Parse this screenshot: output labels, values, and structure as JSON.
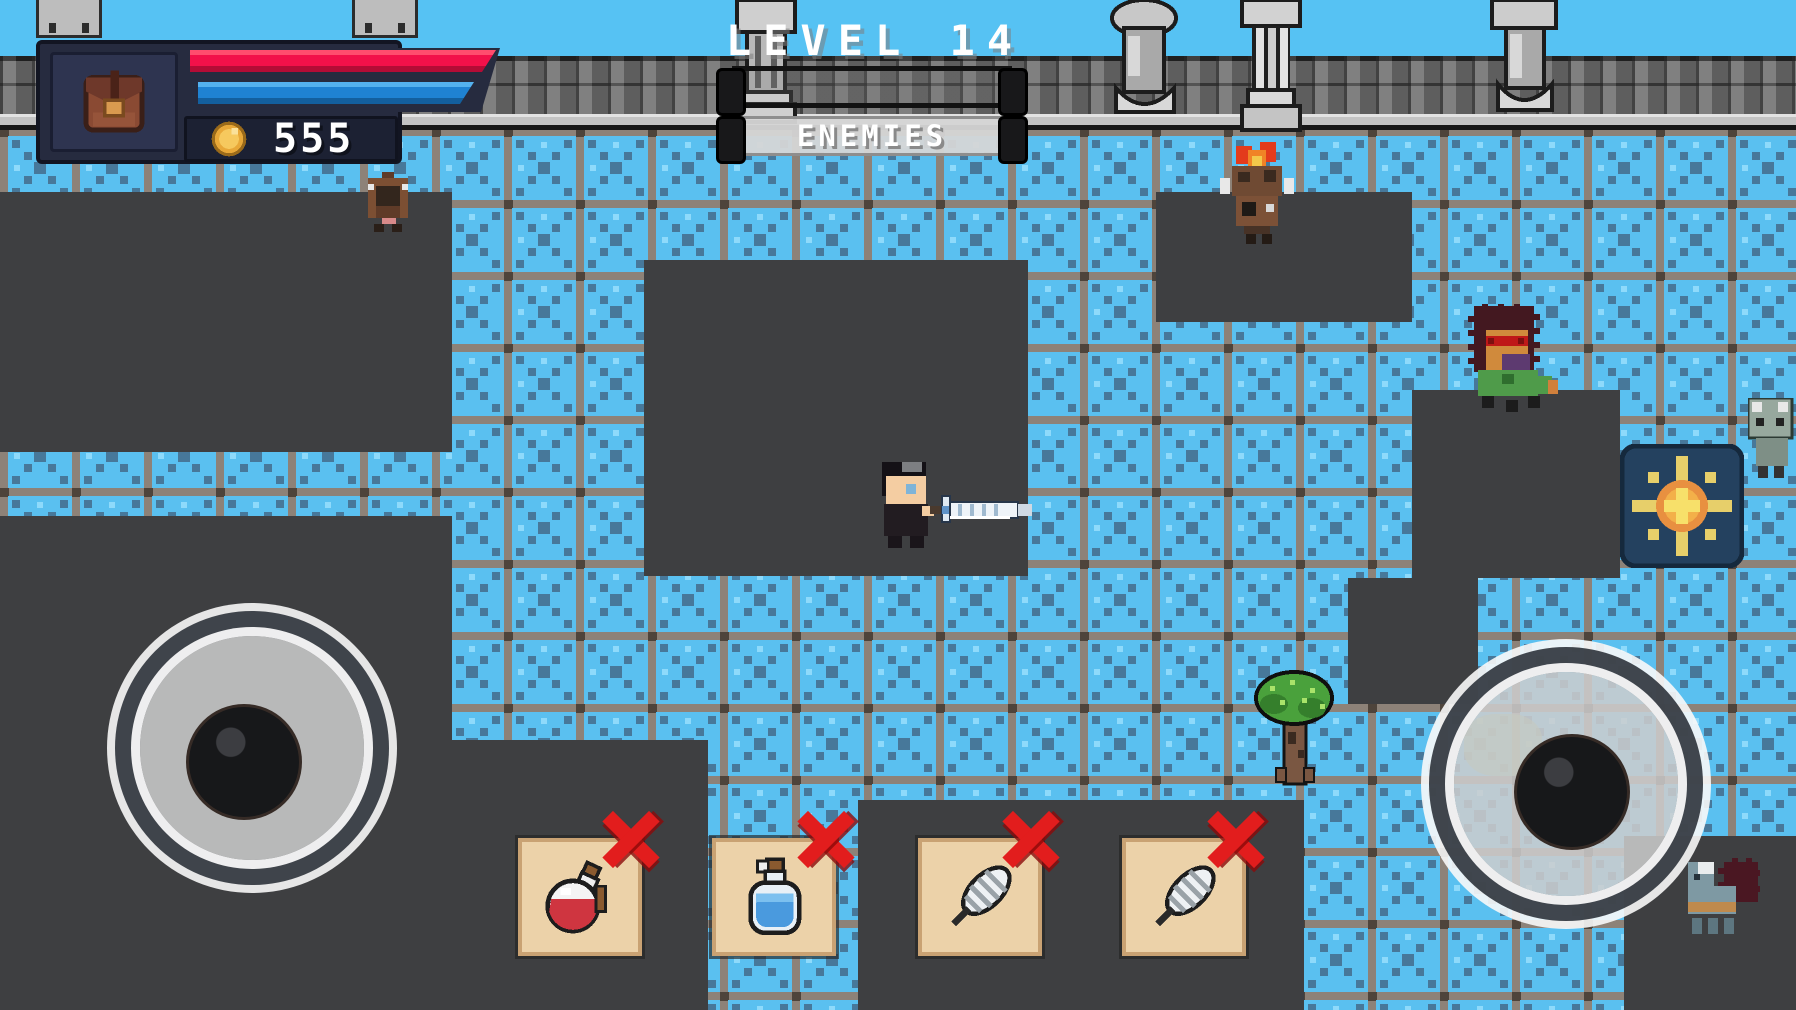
{
  "top": {
    "level_label": "LEVEL 14",
    "enemies_label": "ENEMIES"
  },
  "hud": {
    "coins": "555",
    "health_percent": 100,
    "energy_percent": 92,
    "backpack_icon": "backpack-icon",
    "coin_icon": "coin-icon"
  },
  "bars": {
    "upper_bar": "level-progress-bar (empty)",
    "enemies_bar": "enemies-progress-bar (full)"
  },
  "joysticks": {
    "left": "movement-joystick",
    "right": "aim-joystick"
  },
  "items": {
    "slots": [
      {
        "item": "red-potion",
        "remove_icon": "x-cross"
      },
      {
        "item": "blue-potion",
        "remove_icon": "x-cross"
      },
      {
        "item": "feather",
        "remove_icon": "x-cross"
      },
      {
        "item": "feather",
        "remove_icon": "x-cross"
      }
    ]
  },
  "entities": {
    "player": "player-with-sword",
    "enemies": [
      "brown-beast",
      "flame-head-warrior",
      "spiky-green-brute",
      "gray-golem",
      "blue-llama-with-spike-blob"
    ],
    "props": [
      "tree",
      "sun-rune-tile",
      "stone-columns",
      "castle-wall"
    ]
  },
  "colors": {
    "sky": "#56c2f3",
    "tile_blue": "#5ac0f0",
    "tile_pattern": "#47789a",
    "grout": "#8d8278",
    "floor_dark": "#3e3f41",
    "hud_navy": "#262b3f",
    "health_red": "#f2114a",
    "energy_blue": "#1f82d2",
    "slot_tan": "#ecd2a9",
    "x_red": "#e21d1d",
    "sun_orange": "#e89040",
    "text_white": "#ffffff"
  }
}
